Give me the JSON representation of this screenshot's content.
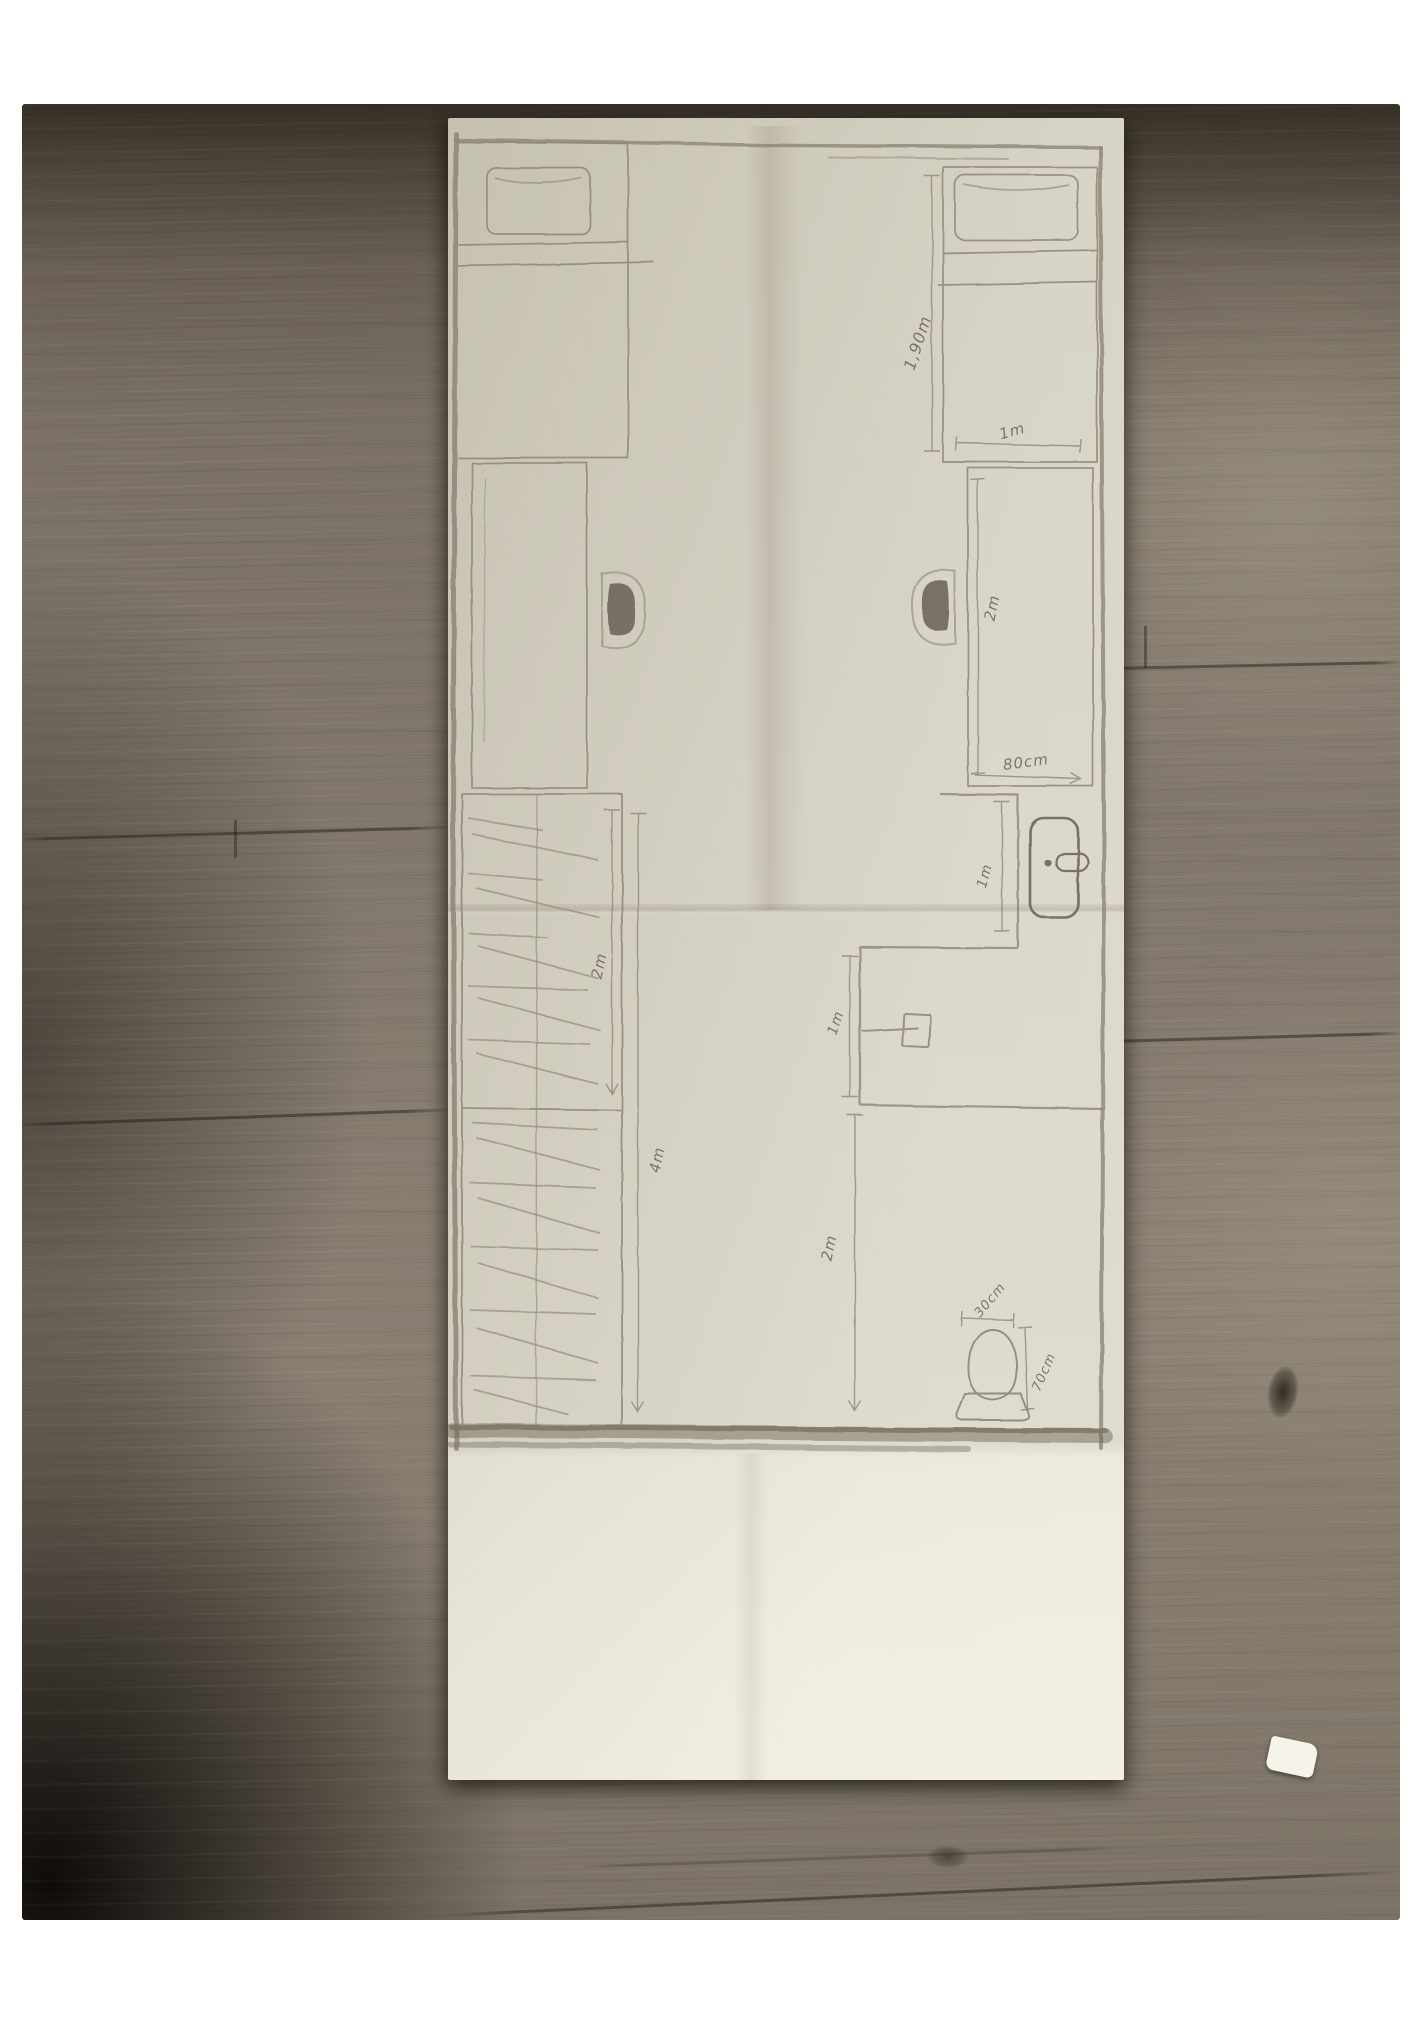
{
  "floorplan": {
    "dimension_labels": {
      "bed_length": "1,90m",
      "bed_width": "1m",
      "desk_length": "2m",
      "desk_width": "80cm",
      "door_width": "1m",
      "bath_sink_wall": "1m",
      "lower_room_length": "2m",
      "wardrobe_upper_length": "2m",
      "wardrobe_total_length": "4m",
      "toilet_width": "30cm",
      "toilet_depth": "70cm"
    },
    "furniture": [
      "bed-left",
      "bed-right",
      "pillow-left",
      "pillow-right",
      "desk-left",
      "desk-right",
      "chair-left",
      "chair-right",
      "wardrobe",
      "door",
      "sink",
      "toilet"
    ],
    "colors": {
      "paper": "#d6d2c3",
      "paper_flap": "#eeebde",
      "pencil": "#8d8575",
      "pencil_dark": "#6e6759",
      "wood_base": "#80766a",
      "wood_dark": "#463f33",
      "wood_shadow": "#16130f",
      "photo_frame": "#ffffff"
    }
  }
}
